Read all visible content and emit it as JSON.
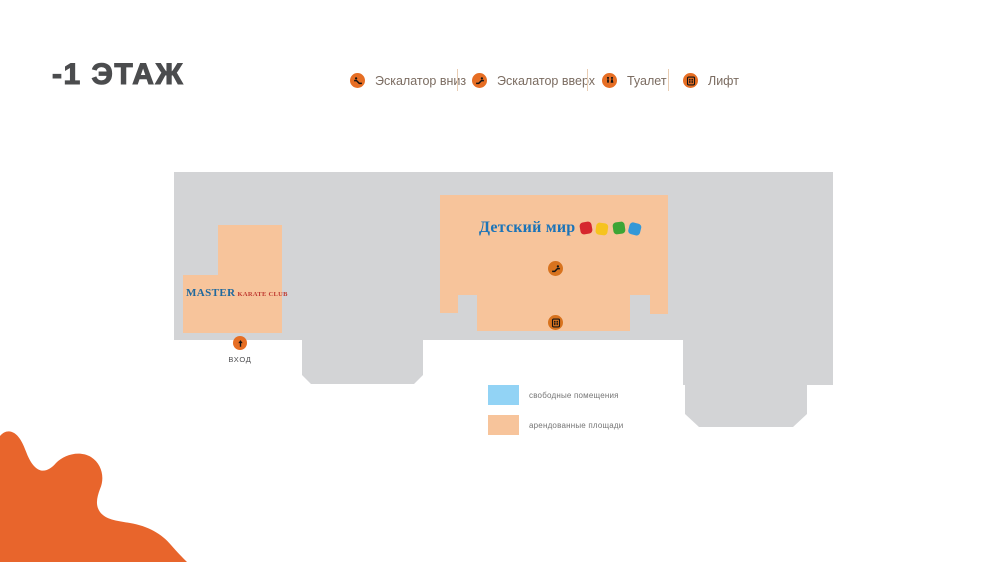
{
  "page": {
    "title": "-1 ЭТАЖ"
  },
  "top_legend": {
    "items": [
      {
        "icon": "escalator-down-icon",
        "label": "Эскалатор вниз"
      },
      {
        "icon": "escalator-up-icon",
        "label": "Эскалатор вверх"
      },
      {
        "icon": "toilet-icon",
        "label": "Туалет"
      },
      {
        "icon": "lift-icon",
        "label": "Лифт"
      }
    ]
  },
  "map": {
    "entrance_label": "ВХОД",
    "stores": [
      {
        "id": "master-karate-club",
        "name": "MASTER KARATE CLUB",
        "name_part1": "MASTER",
        "name_part2": "KARATE CLUB"
      },
      {
        "id": "detsky-mir",
        "name": "Детский мир"
      }
    ],
    "dm_logo": {
      "text": "Детский мир",
      "squares": [
        "#D6272E",
        "#F6C31E",
        "#3DA535",
        "#3398D8"
      ]
    }
  },
  "area_legend": {
    "items": [
      {
        "label": "свободные помещения",
        "color": "#92D3F5"
      },
      {
        "label": "арендованные площади",
        "color": "#F7C49B"
      }
    ]
  },
  "colors": {
    "accent_orange": "#E66E24",
    "map_icon_orange": "#D8731E",
    "blob_orange": "#E8652C",
    "floor_gray": "#D3D4D6",
    "rented_peach": "#F7C49B",
    "free_blue": "#92D3F5",
    "dm_blue": "#1C74B8",
    "master_blue": "#20699E",
    "master_red": "#BF3A31"
  }
}
